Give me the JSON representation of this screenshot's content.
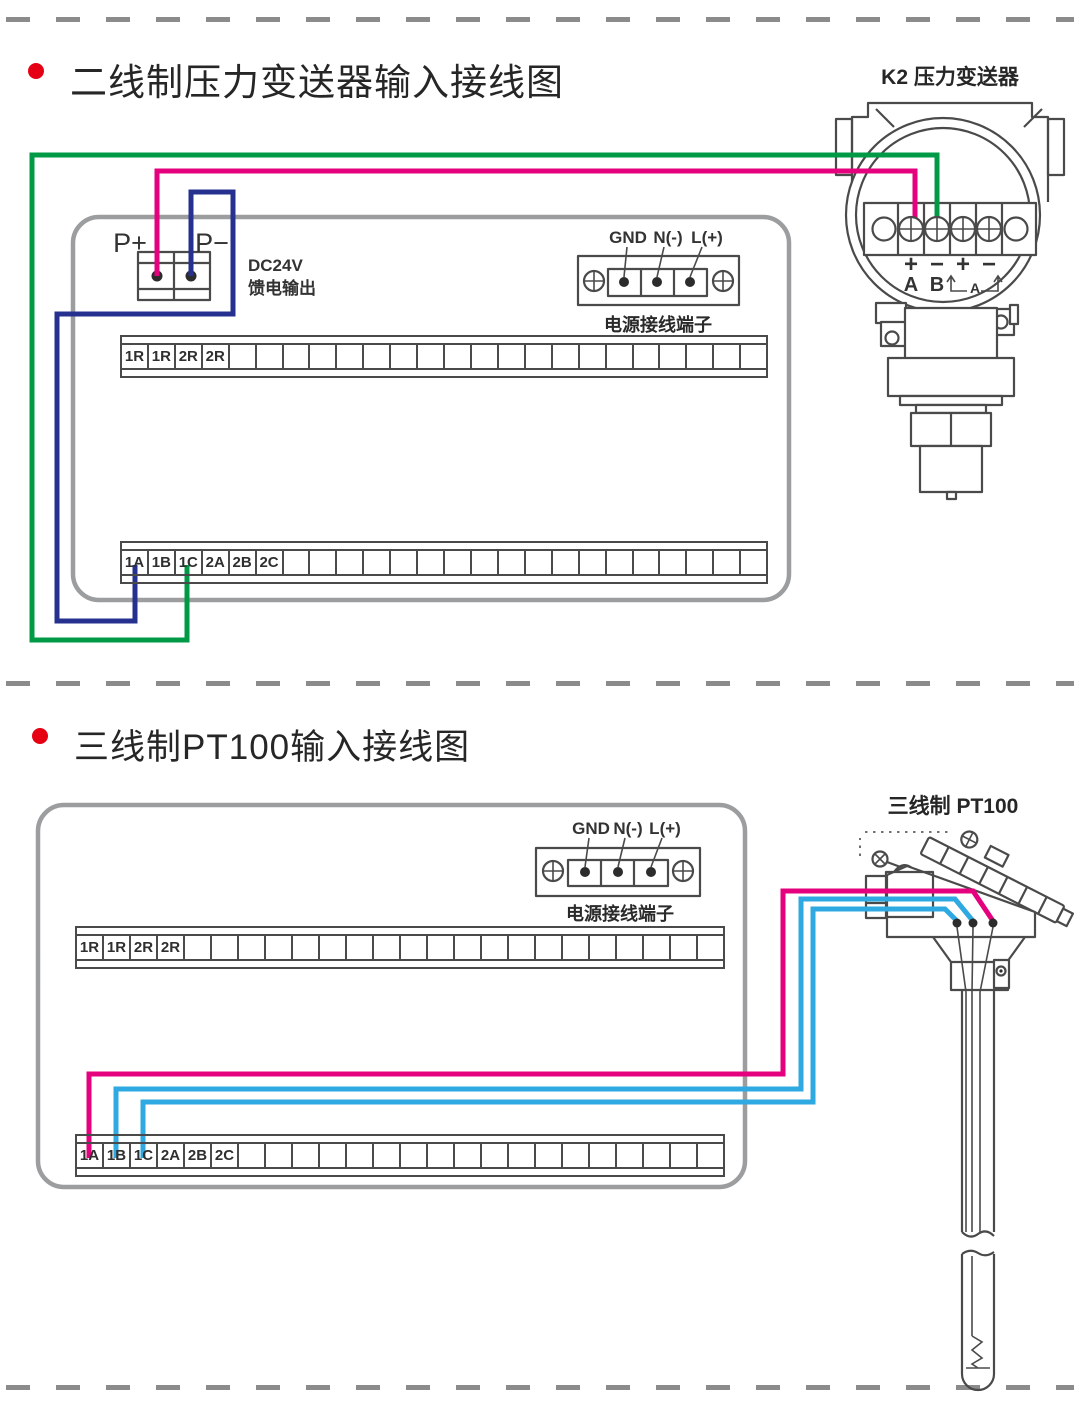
{
  "colors": {
    "magenta": "#E5007E",
    "green": "#009A47",
    "navy": "#26308F",
    "cyan": "#2FA9E1",
    "panel": "#9C9D9F",
    "line": "#4A4A4A",
    "red": "#E60013",
    "dash": "#8B8B8B",
    "text": "#2B2B2B"
  },
  "s1": {
    "title": "二线制压力变送器输入接线图",
    "device_label": "K2  压力变送器",
    "dc_supply": {
      "p_plus": "P+",
      "p_minus": "P−",
      "line1": "DC24V",
      "line2": "馈电输出"
    },
    "power": {
      "labels": [
        "GND",
        "N(-)",
        "L(+)"
      ],
      "caption": "电源接线端子"
    },
    "transmitter": {
      "signs": [
        "+",
        "−",
        "+",
        "−"
      ],
      "names": [
        "A",
        "B"
      ],
      "bracket_label": "A"
    }
  },
  "s2": {
    "title": "三线制PT100输入接线图",
    "device_label": "三线制  PT100",
    "power": {
      "labels": [
        "GND",
        "N(-)",
        "L(+)"
      ],
      "caption": "电源接线端子"
    }
  },
  "strips": {
    "s1top": {
      "cells": 24,
      "labels": [
        "1R",
        "1R",
        "2R",
        "2R"
      ]
    },
    "s1bot": {
      "cells": 24,
      "labels": [
        "1A",
        "1B",
        "1C",
        "2A",
        "2B",
        "2C"
      ]
    },
    "s2top": {
      "cells": 24,
      "labels": [
        "1R",
        "1R",
        "2R",
        "2R"
      ]
    },
    "s2bot": {
      "cells": 24,
      "labels": [
        "1A",
        "1B",
        "1C",
        "2A",
        "2B",
        "2C"
      ]
    }
  }
}
